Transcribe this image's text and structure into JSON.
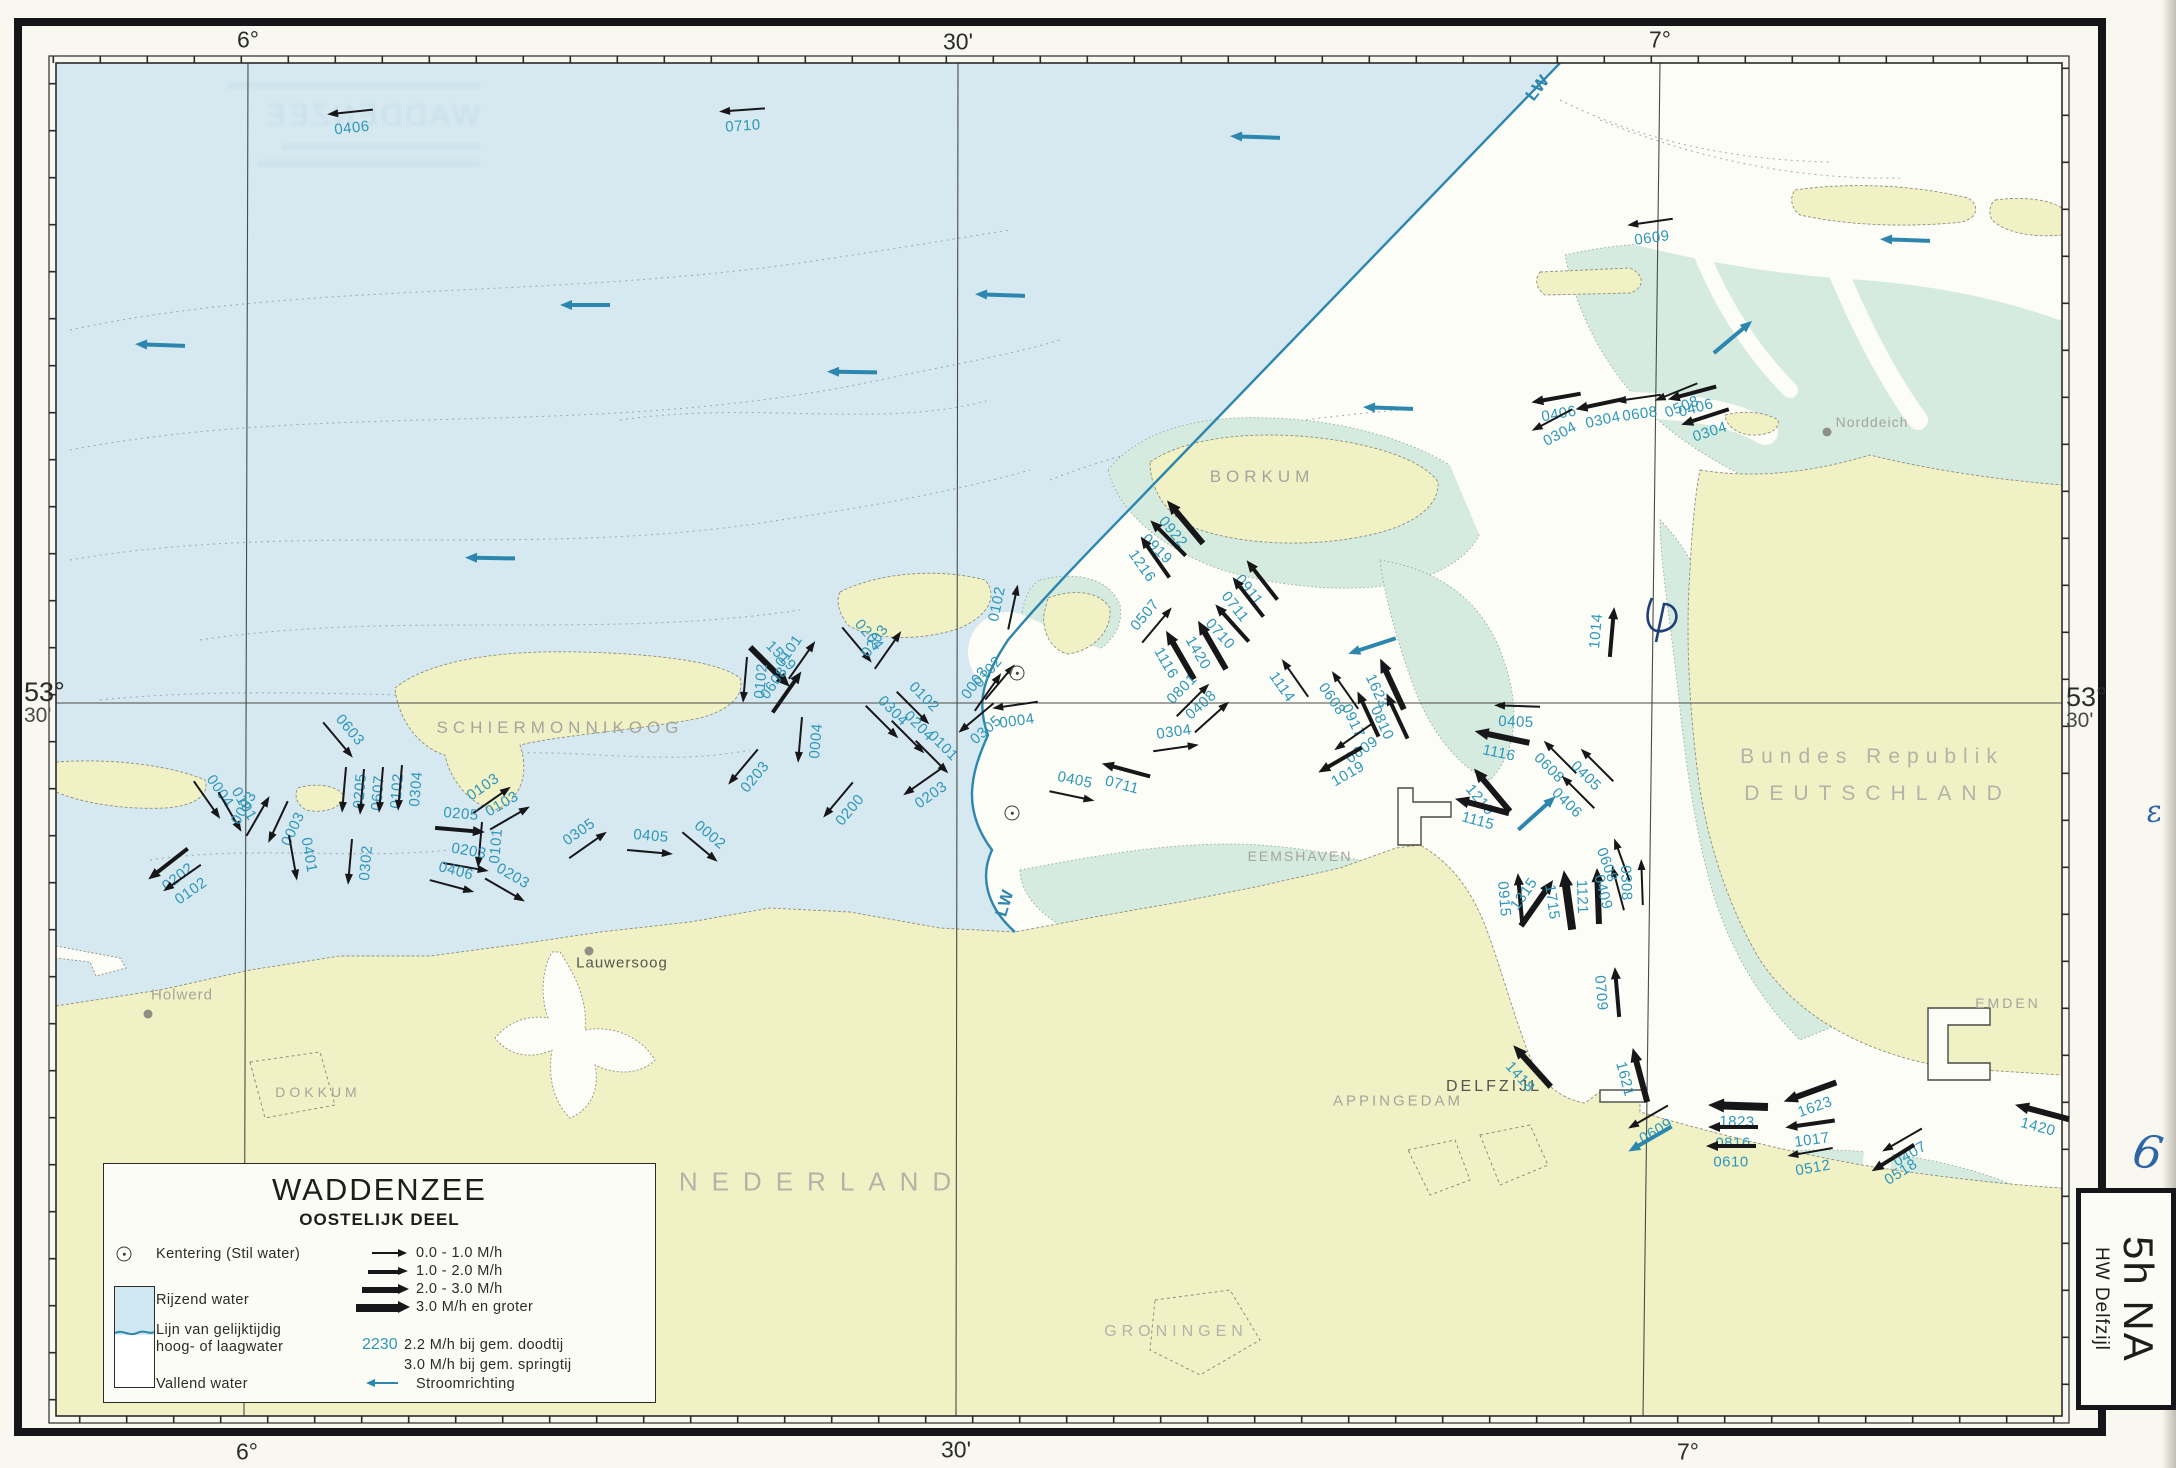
{
  "chart_title": "Waddenzee tidal stream chart, eastern part, 5h after HW Delfzijl",
  "legend": {
    "title": "WADDENZEE",
    "subtitle": "OOSTELIJK DEEL",
    "kentering": "Kentering (Stil water)",
    "rijzend": "Rijzend water",
    "lijn1": "Lijn van gelijktijdig",
    "lijn2": "hoog- of laagwater",
    "vallend": "Vallend water",
    "speed_classes": [
      "0.0 - 1.0 M/h",
      "1.0 - 2.0 M/h",
      "2.0 - 3.0 M/h",
      "3.0 M/h en groter"
    ],
    "sample_value": "2230",
    "sample_line1": "2.2 M/h bij gem. doodtij",
    "sample_line2": "3.0 M/h bij gem. springtij",
    "stroomrichting": "Stroomrichting"
  },
  "side_tab": {
    "big": "5h NA",
    "small": "HW Delfzijl"
  },
  "frame": {
    "top": [
      {
        "t": "6°",
        "x": 248,
        "y": 40
      },
      {
        "t": "30'",
        "x": 958,
        "y": 42
      },
      {
        "t": "7°",
        "x": 1660,
        "y": 40
      }
    ],
    "bottom": [
      {
        "t": "6°",
        "x": 247,
        "y": 1452
      },
      {
        "t": "30'",
        "x": 956,
        "y": 1450
      },
      {
        "t": "7°",
        "x": 1688,
        "y": 1452
      }
    ],
    "left": {
      "deg": "53°",
      "min": "30'",
      "x": 24,
      "y": 680
    },
    "right": {
      "deg": "53°",
      "min": "30'",
      "x": 2066,
      "y": 685
    }
  },
  "ghost": {
    "word": "WADDENZEE"
  },
  "places": [
    {
      "t": "SCHIERMONNIKOOG",
      "x": 560,
      "y": 728,
      "fs": 17,
      "ls": 5,
      "col": "gray"
    },
    {
      "t": "BORKUM",
      "x": 1262,
      "y": 477,
      "fs": 17,
      "ls": 5,
      "col": "gray"
    },
    {
      "t": "NEDERLAND",
      "x": 822,
      "y": 1182,
      "fs": 26,
      "ls": 14,
      "col": "light"
    },
    {
      "t": "Bundes Republik",
      "x": 1872,
      "y": 757,
      "fs": 21,
      "ls": 7,
      "col": "light"
    },
    {
      "t": "DEUTSCHLAND",
      "x": 1878,
      "y": 794,
      "fs": 21,
      "ls": 10,
      "col": "light"
    },
    {
      "t": "GRONINGEN",
      "x": 1176,
      "y": 1332,
      "fs": 16,
      "ls": 5,
      "col": "light"
    },
    {
      "t": "DOKKUM",
      "x": 318,
      "y": 1092,
      "fs": 14,
      "ls": 4,
      "col": "gray"
    },
    {
      "t": "EEMSHAVEN",
      "x": 1300,
      "y": 856,
      "fs": 14,
      "ls": 2,
      "col": "gray"
    },
    {
      "t": "APPINGEDAM",
      "x": 1398,
      "y": 1101,
      "fs": 15,
      "ls": 3,
      "col": "gray"
    },
    {
      "t": "DELFZIJL",
      "x": 1494,
      "y": 1087,
      "fs": 16,
      "ls": 3,
      "col": "dark"
    },
    {
      "t": "EMDEN",
      "x": 2008,
      "y": 1003,
      "fs": 14,
      "ls": 3,
      "col": "gray"
    },
    {
      "t": "Holwerd",
      "x": 182,
      "y": 995,
      "fs": 15,
      "ls": 1,
      "col": "gray",
      "dot": {
        "x": 148,
        "y": 1014
      }
    },
    {
      "t": "Lauwersoog",
      "x": 622,
      "y": 963,
      "fs": 15,
      "ls": 1,
      "col": "dark",
      "dot": {
        "x": 589,
        "y": 951
      }
    },
    {
      "t": "Norddeich",
      "x": 1872,
      "y": 422,
      "fs": 14,
      "ls": 1,
      "col": "gray",
      "dot": {
        "x": 1827,
        "y": 432
      }
    }
  ],
  "water_labels": [
    {
      "t": "LW",
      "x": 1538,
      "y": 88,
      "r": -52
    },
    {
      "t": "LW",
      "x": 1005,
      "y": 903,
      "r": -73
    }
  ],
  "arrows": [
    {
      "t": "0406",
      "x": 350,
      "y": 112,
      "a": 174,
      "c": 1
    },
    {
      "t": "0710",
      "x": 742,
      "y": 110,
      "a": 176,
      "c": 1
    },
    {
      "t": "0609",
      "x": 1650,
      "y": 222,
      "a": 172,
      "c": 1
    },
    {
      "t": "0406",
      "x": 1556,
      "y": 398,
      "a": 170,
      "c": 2
    },
    {
      "t": "0304",
      "x": 1600,
      "y": 404,
      "a": 168,
      "c": 2
    },
    {
      "t": "0608",
      "x": 1638,
      "y": 398,
      "a": 172,
      "c": 1
    },
    {
      "t": "0508",
      "x": 1676,
      "y": 392,
      "a": 158,
      "c": 1
    },
    {
      "t": "0406",
      "x": 1692,
      "y": 393,
      "a": 165,
      "c": 2
    },
    {
      "t": "0304",
      "x": 1705,
      "y": 417,
      "a": 162,
      "c": 2
    },
    {
      "t": "0304",
      "x": 1552,
      "y": 420,
      "a": 152,
      "c": 1
    },
    {
      "t": "0004",
      "x": 207,
      "y": 800,
      "a": 55,
      "c": 1
    },
    {
      "t": "0101",
      "x": 230,
      "y": 812,
      "a": 60,
      "c": 1
    },
    {
      "t": "0202",
      "x": 168,
      "y": 864,
      "a": 142,
      "c": 2
    },
    {
      "t": "0102",
      "x": 182,
      "y": 878,
      "a": 145,
      "c": 1
    },
    {
      "t": "0003",
      "x": 258,
      "y": 816,
      "a": -60,
      "c": 1
    },
    {
      "t": "0003",
      "x": 278,
      "y": 822,
      "a": 115,
      "c": 1
    },
    {
      "t": "0401",
      "x": 293,
      "y": 858,
      "a": 80,
      "c": 1
    },
    {
      "t": "0302",
      "x": 350,
      "y": 862,
      "a": 95,
      "c": 1
    },
    {
      "t": "0603",
      "x": 338,
      "y": 740,
      "a": 50,
      "c": 1
    },
    {
      "t": "0205",
      "x": 344,
      "y": 790,
      "a": 95,
      "c": 1
    },
    {
      "t": "0607",
      "x": 362,
      "y": 792,
      "a": 95,
      "c": 1
    },
    {
      "t": "0102",
      "x": 381,
      "y": 790,
      "a": 95,
      "c": 1
    },
    {
      "t": "0304",
      "x": 400,
      "y": 788,
      "a": 95,
      "c": 1
    },
    {
      "t": "0103",
      "x": 492,
      "y": 800,
      "a": -35,
      "c": 1
    },
    {
      "t": "0103",
      "x": 510,
      "y": 818,
      "a": -30,
      "c": 1
    },
    {
      "t": "0205",
      "x": 460,
      "y": 830,
      "a": 5,
      "c": 2
    },
    {
      "t": "0101",
      "x": 480,
      "y": 845,
      "a": 95,
      "c": 1
    },
    {
      "t": "0203",
      "x": 466,
      "y": 867,
      "a": 10,
      "c": 1
    },
    {
      "t": "0406",
      "x": 452,
      "y": 886,
      "a": 15,
      "c": 1
    },
    {
      "t": "0203",
      "x": 505,
      "y": 890,
      "a": 30,
      "c": 1
    },
    {
      "t": "0305",
      "x": 588,
      "y": 845,
      "a": -35,
      "c": 1
    },
    {
      "t": "0405",
      "x": 650,
      "y": 852,
      "a": 5,
      "c": 1
    },
    {
      "t": "0002",
      "x": 700,
      "y": 847,
      "a": 40,
      "c": 1
    },
    {
      "t": "1519",
      "x": 770,
      "y": 667,
      "a": 45,
      "c": 3
    },
    {
      "t": "0102",
      "x": 745,
      "y": 680,
      "a": 95,
      "c": 1
    },
    {
      "t": "0101",
      "x": 802,
      "y": 660,
      "a": -55,
      "c": 1
    },
    {
      "t": "0608",
      "x": 787,
      "y": 692,
      "a": -55,
      "c": 2
    },
    {
      "t": "0203",
      "x": 743,
      "y": 767,
      "a": 130,
      "c": 1
    },
    {
      "t": "0004",
      "x": 800,
      "y": 740,
      "a": 95,
      "c": 1
    },
    {
      "t": "0200",
      "x": 838,
      "y": 800,
      "a": 130,
      "c": 1
    },
    {
      "t": "0204",
      "x": 857,
      "y": 645,
      "a": 50,
      "c": 1
    },
    {
      "t": "0203",
      "x": 888,
      "y": 650,
      "a": -55,
      "c": 1
    },
    {
      "t": "0304",
      "x": 882,
      "y": 722,
      "a": 45,
      "c": 1
    },
    {
      "t": "0102",
      "x": 913,
      "y": 708,
      "a": 45,
      "c": 1
    },
    {
      "t": "0204",
      "x": 908,
      "y": 737,
      "a": 45,
      "c": 1
    },
    {
      "t": "0101",
      "x": 932,
      "y": 757,
      "a": 45,
      "c": 1
    },
    {
      "t": "0203",
      "x": 922,
      "y": 782,
      "a": 145,
      "c": 1
    },
    {
      "t": "0102",
      "x": 1013,
      "y": 607,
      "a": -78,
      "c": 1
    },
    {
      "t": "0102",
      "x": 1000,
      "y": 682,
      "a": -50,
      "c": 1
    },
    {
      "t": "0003",
      "x": 988,
      "y": 692,
      "a": -55,
      "c": 1
    },
    {
      "t": "0305",
      "x": 976,
      "y": 718,
      "a": 140,
      "c": 1
    },
    {
      "t": "0004",
      "x": 1015,
      "y": 705,
      "a": 172,
      "c": 1
    },
    {
      "t": "0711",
      "x": 1126,
      "y": 770,
      "a": 195,
      "c": 2
    },
    {
      "t": "0405",
      "x": 1072,
      "y": 796,
      "a": 12,
      "c": 1
    },
    {
      "t": "0922",
      "x": 1185,
      "y": 522,
      "a": 230,
      "c": 3
    },
    {
      "t": "0919",
      "x": 1168,
      "y": 538,
      "a": 225,
      "c": 2
    },
    {
      "t": "1216",
      "x": 1155,
      "y": 557,
      "a": 235,
      "c": 2
    },
    {
      "t": "0911",
      "x": 1262,
      "y": 580,
      "a": 232,
      "c": 2
    },
    {
      "t": "0711",
      "x": 1248,
      "y": 597,
      "a": 232,
      "c": 2
    },
    {
      "t": "0710",
      "x": 1232,
      "y": 623,
      "a": 228,
      "c": 2
    },
    {
      "t": "1420",
      "x": 1212,
      "y": 645,
      "a": 240,
      "c": 3
    },
    {
      "t": "1116",
      "x": 1180,
      "y": 655,
      "a": 240,
      "c": 3
    },
    {
      "t": "0507",
      "x": 1157,
      "y": 625,
      "a": -50,
      "c": 1
    },
    {
      "t": "0801",
      "x": 1193,
      "y": 700,
      "a": -45,
      "c": 1
    },
    {
      "t": "0408",
      "x": 1212,
      "y": 717,
      "a": -42,
      "c": 1
    },
    {
      "t": "0304",
      "x": 1176,
      "y": 748,
      "a": -8,
      "c": 1
    },
    {
      "t": "1114",
      "x": 1295,
      "y": 678,
      "a": 235,
      "c": 1
    },
    {
      "t": "0608",
      "x": 1345,
      "y": 690,
      "a": 235,
      "c": 1
    },
    {
      "t": "0917",
      "x": 1368,
      "y": 714,
      "a": 245,
      "c": 2
    },
    {
      "t": "1623",
      "x": 1392,
      "y": 684,
      "a": 245,
      "c": 3
    },
    {
      "t": "0810",
      "x": 1397,
      "y": 716,
      "a": 245,
      "c": 2
    },
    {
      "t": "0609",
      "x": 1353,
      "y": 737,
      "a": 145,
      "c": 1
    },
    {
      "t": "1019",
      "x": 1340,
      "y": 760,
      "a": 150,
      "c": 2
    },
    {
      "t": "0405",
      "x": 1517,
      "y": 706,
      "a": 182,
      "c": 1
    },
    {
      "t": "1116",
      "x": 1502,
      "y": 737,
      "a": 192,
      "c": 3
    },
    {
      "t": "0608",
      "x": 1560,
      "y": 757,
      "a": 225,
      "c": 1
    },
    {
      "t": "0405",
      "x": 1597,
      "y": 765,
      "a": 225,
      "c": 1
    },
    {
      "t": "0406",
      "x": 1578,
      "y": 792,
      "a": 225,
      "c": 1
    },
    {
      "t": "1014",
      "x": 1612,
      "y": 632,
      "a": 275,
      "c": 2
    },
    {
      "t": "1219",
      "x": 1492,
      "y": 790,
      "a": 230,
      "c": 3
    },
    {
      "t": "1115",
      "x": 1482,
      "y": 806,
      "a": 195,
      "c": 3
    },
    {
      "t": "0915",
      "x": 1520,
      "y": 898,
      "a": 265,
      "c": 2
    },
    {
      "t": "1315",
      "x": 1537,
      "y": 903,
      "a": -55,
      "c": 3
    },
    {
      "t": "1715",
      "x": 1568,
      "y": 900,
      "a": 262,
      "c": 4
    },
    {
      "t": "1121",
      "x": 1598,
      "y": 896,
      "a": 268,
      "c": 3
    },
    {
      "t": "0409",
      "x": 1618,
      "y": 888,
      "a": 255,
      "c": 1
    },
    {
      "t": "0608",
      "x": 1622,
      "y": 860,
      "a": 250,
      "c": 1
    },
    {
      "t": "0308",
      "x": 1642,
      "y": 882,
      "a": 268,
      "c": 1
    },
    {
      "t": "0709",
      "x": 1617,
      "y": 992,
      "a": 265,
      "c": 2
    },
    {
      "t": "1418",
      "x": 1532,
      "y": 1066,
      "a": 228,
      "c": 3
    },
    {
      "t": "1621",
      "x": 1640,
      "y": 1075,
      "a": 255,
      "c": 3
    },
    {
      "t": "0609",
      "x": 1648,
      "y": 1117,
      "a": 150,
      "c": 1
    },
    {
      "t": "1823",
      "x": 1738,
      "y": 1106,
      "a": 182,
      "c": 4
    },
    {
      "t": "0816",
      "x": 1733,
      "y": 1127,
      "a": 180,
      "c": 2
    },
    {
      "t": "0610",
      "x": 1731,
      "y": 1146,
      "a": 180,
      "c": 2
    },
    {
      "t": "1623",
      "x": 1810,
      "y": 1092,
      "a": 160,
      "c": 3
    },
    {
      "t": "1017",
      "x": 1810,
      "y": 1124,
      "a": 172,
      "c": 2
    },
    {
      "t": "0512",
      "x": 1810,
      "y": 1152,
      "a": 170,
      "c": 1
    },
    {
      "t": "0407",
      "x": 1902,
      "y": 1140,
      "a": 150,
      "c": 1
    },
    {
      "t": "0518",
      "x": 1893,
      "y": 1158,
      "a": 148,
      "c": 2
    },
    {
      "t": "1420",
      "x": 2042,
      "y": 1112,
      "a": 195,
      "c": 3
    }
  ],
  "direction_arrows": [
    {
      "x": 1255,
      "y": 137,
      "a": 182
    },
    {
      "x": 160,
      "y": 345,
      "a": 182
    },
    {
      "x": 585,
      "y": 305,
      "a": 180
    },
    {
      "x": 852,
      "y": 372,
      "a": 181
    },
    {
      "x": 490,
      "y": 558,
      "a": 181
    },
    {
      "x": 1000,
      "y": 295,
      "a": 182
    },
    {
      "x": 1388,
      "y": 408,
      "a": 182
    },
    {
      "x": 1905,
      "y": 240,
      "a": 182
    },
    {
      "x": 1733,
      "y": 337,
      "a": -40
    },
    {
      "x": 1537,
      "y": 813,
      "a": -42
    },
    {
      "x": 1372,
      "y": 646,
      "a": 162
    },
    {
      "x": 1650,
      "y": 1139,
      "a": 150
    }
  ],
  "kentering_points": [
    {
      "x": 1017,
      "y": 673
    },
    {
      "x": 1012,
      "y": 813
    }
  ],
  "handwriting": [
    {
      "t": "6",
      "x": 2148,
      "y": 1152,
      "r": 10,
      "size": 46
    },
    {
      "t": "ε",
      "x": 2154,
      "y": 812,
      "r": -8,
      "size": 30
    }
  ],
  "colors": {
    "sea": "#d6e9f1",
    "flats": "#d6ebdf",
    "land": "#f1f1c6",
    "falling_white": "#fdfdf8",
    "lw_line": "#2d86ad",
    "arrow_black": "#17171a",
    "speed_label": "#2f96ba",
    "place_gray": "#a5a59b",
    "place_dark": "#55554d",
    "place_light": "#b3b3a7"
  }
}
